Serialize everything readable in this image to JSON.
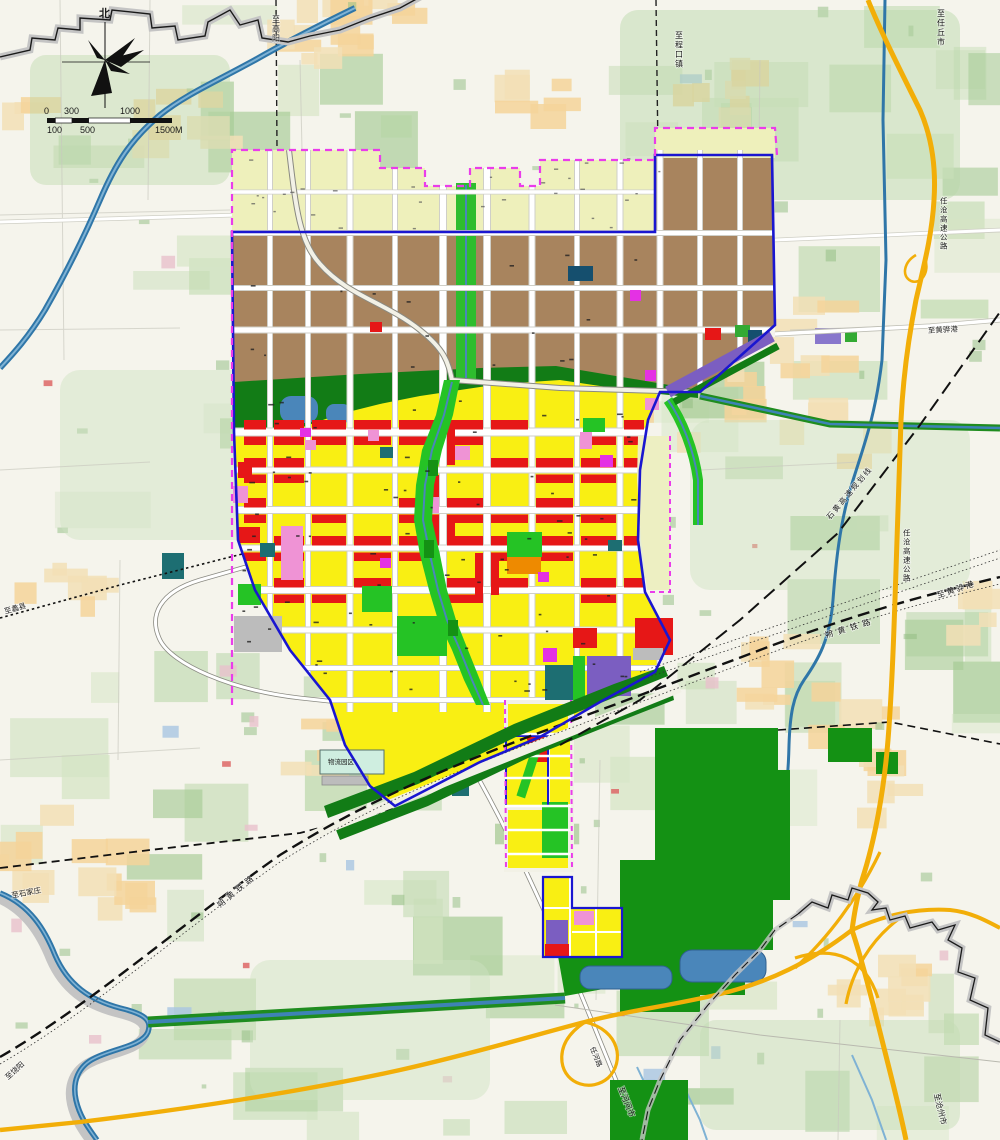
{
  "map": {
    "compass": {
      "north_label": "北"
    },
    "scalebar": {
      "top": [
        "0",
        "300",
        "1000"
      ],
      "bottom": [
        "100",
        "500",
        "1500M"
      ]
    },
    "labels": {
      "to_gaoyang": "至高阳",
      "to_chengkou": "至程口镇",
      "to_renqiu": "至任丘市",
      "rencang_expwy_n": "任沧高速公路",
      "rencang_expwy_s": "任沧高速公路",
      "to_huanghua_n": "至黄骅港",
      "shihuang_line": "石黄高速规划线",
      "to_huanghua_e": "至黄骅港",
      "shuohuang_rail_e": "朔黄铁路",
      "shuohuang_rail_w": "朔黄铁路",
      "to_shijiazhuang": "至石家庄",
      "to_lixian": "至蠡县",
      "to_raoyang": "至饶阳",
      "to_hejian": "至河间市",
      "renhe_road": "任河路",
      "to_cangzhou": "至沧州市",
      "logistics_park": "物流园区"
    },
    "palette": {
      "background": "#f5f4ec",
      "patch_green_1": "#d5e5c5",
      "patch_green_2": "#bed9ad",
      "patch_green_3": "#a6cb95",
      "patch_tan": "#f2dfb6",
      "patch_orange": "#f5d49a",
      "patch_blue": "#a9c6e2",
      "patch_pink": "#e9c0cc",
      "water": "#2f76a8",
      "lake": "#4a86ba",
      "boundary_gray": "#c4c4c4",
      "highway_yellow": "#f2ae08",
      "city_boundary_blue": "#1a16d0",
      "planning_magenta": "#ea3cea",
      "industrial_brown": "#a8845e",
      "reserve_pale": "#eef0bb",
      "residential_yellow": "#f9ef13",
      "commercial_red": "#e61717",
      "park_green": "#25c325",
      "forest_green": "#149114",
      "band_green": "#127c16",
      "purple_zone": "#7b5ec1",
      "pink_zone": "#ef93d5",
      "magenta_zone": "#e431e4",
      "teal_zone": "#1d6e72",
      "orange_zone": "#ee8a00",
      "gray_zone": "#bcbcbc",
      "logistics_cyan": "#cfeee0",
      "road_white": "#ffffff"
    }
  }
}
